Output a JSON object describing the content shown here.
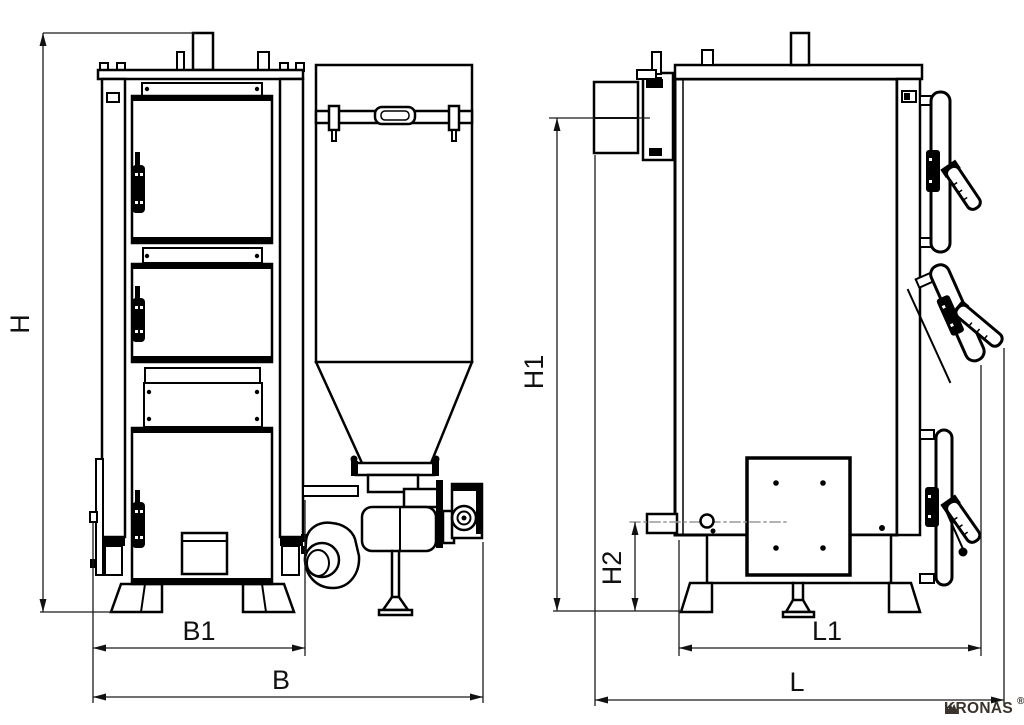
{
  "drawing": {
    "subject": "boiler dimension drawing, front view with pellet hopper and side view",
    "labels": {
      "h": "H",
      "b1": "B1",
      "b": "B",
      "h1": "H1",
      "h2": "H2",
      "l1": "L1",
      "l": "L"
    }
  },
  "brand": {
    "name": "KRONAS",
    "registered": "®",
    "color": "#3a332b"
  },
  "colors": {
    "line": "#000000",
    "dimension": "#1a1a1a",
    "background": "#ffffff",
    "centerline": "#999999"
  }
}
